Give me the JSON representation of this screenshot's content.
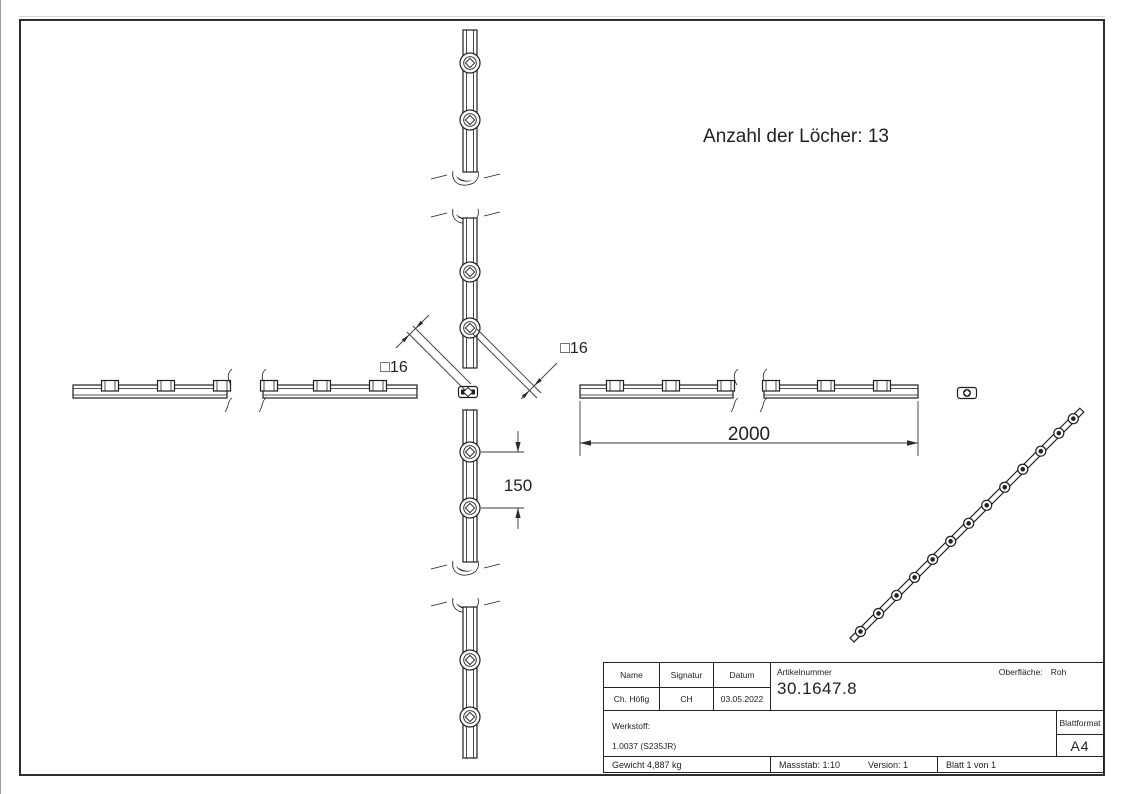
{
  "annotation": {
    "hole_count": "Anzahl der Löcher: 13"
  },
  "dimensions": {
    "length": "2000",
    "spacing": "150",
    "profile_left": "□16",
    "profile_right": "□16"
  },
  "title_block": {
    "name_label": "Name",
    "signatur_label": "Signatur",
    "datum_label": "Datum",
    "artikelnummer_label": "Artikelnummer",
    "oberflaeche_label": "Oberfläche:",
    "oberflaeche_value": "Roh",
    "name_value": "Ch. Höfig",
    "signatur_value": "CH",
    "datum_value": "03.05.2022",
    "artikelnummer_value": "30.1647.8",
    "werkstoff_label": "Werkstoff:",
    "werkstoff_value": "1.0037 (S235JR)",
    "blattformat_label": "Blattformat",
    "blattformat_value": "A4",
    "gewicht": "Gewicht 4,887 kg",
    "massstab": "Massstab: 1:10",
    "version": "Version: 1",
    "blatt": "Blatt 1 von 1"
  },
  "colors": {
    "line": "#1f1f1f",
    "dim": "#3a3a3a",
    "background": "#ffffff"
  }
}
